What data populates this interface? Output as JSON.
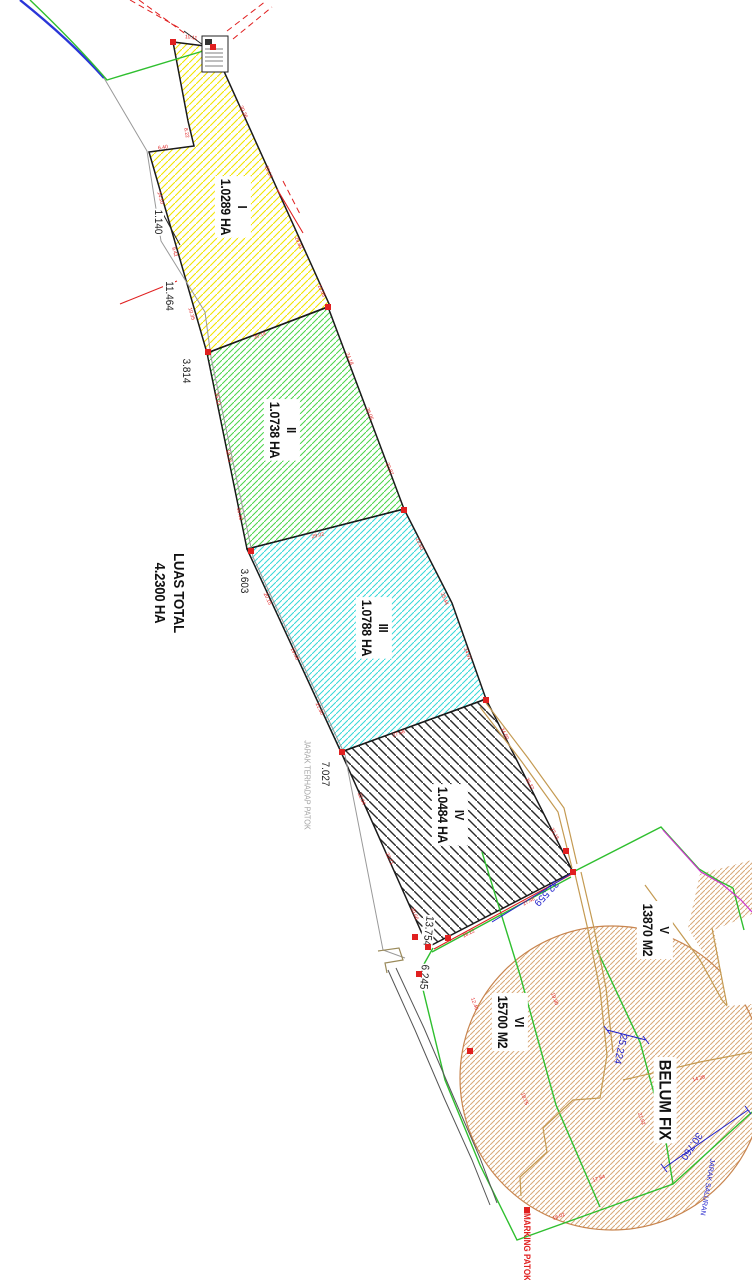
{
  "parcels": [
    {
      "numeral": "I",
      "area": "1.0289 HA"
    },
    {
      "numeral": "II",
      "area": "1.0738 HA"
    },
    {
      "numeral": "III",
      "area": "1.0788 HA"
    },
    {
      "numeral": "IV",
      "area": "1.0484 HA"
    },
    {
      "numeral": "V",
      "area": "13870 M2"
    },
    {
      "numeral": "VI",
      "area": "15700 M2"
    }
  ],
  "total": {
    "line1": "LUAS TOTAL",
    "line2": "4.2300 HA"
  },
  "annotations": {
    "belum_fix": "BELUM FIX",
    "jarak_terhadap_patok": "JARAK TERHADAP PATOK",
    "marking_patok": "MARKING PATOK",
    "jarak_saluran": "JARAK SALURAN"
  },
  "measurements": {
    "m1": "1.140",
    "m2": "11.464",
    "m3": "3.814",
    "m4": "3.603",
    "m5": "7.027",
    "m6": "13.754",
    "m7": "6.245"
  },
  "blue_dims": {
    "d1": "32.559",
    "d2": "25.224",
    "d3": "30.760"
  },
  "colors": {
    "hatch_yellow": "#f2e400",
    "hatch_green": "#4ad54a",
    "hatch_cyan": "#35d8d8",
    "hatch_black": "#2a2a2a",
    "hatch_brown": "#d8a878",
    "boundary_green": "#2fbf2f",
    "line_blue": "#2a35d8",
    "dim_blue": "#2222cc",
    "line_red": "#e02020",
    "line_magenta": "#cc33cc",
    "road_tan": "#c49a52"
  },
  "edge_dims": [
    {
      "v": "30.26",
      "x": 243,
      "y": 112,
      "a": 66
    },
    {
      "v": "28.14",
      "x": 268,
      "y": 172,
      "a": 66
    },
    {
      "v": "29.83",
      "x": 298,
      "y": 243,
      "a": 66
    },
    {
      "v": "10.05",
      "x": 321,
      "y": 291,
      "a": 66
    },
    {
      "v": "10.11",
      "x": 191,
      "y": 38,
      "a": 7
    },
    {
      "v": "14.10",
      "x": 160,
      "y": 198,
      "a": 74
    },
    {
      "v": "9.42",
      "x": 174,
      "y": 252,
      "a": 74
    },
    {
      "v": "10.35",
      "x": 191,
      "y": 314,
      "a": 74
    },
    {
      "v": "6.40",
      "x": 163,
      "y": 148,
      "a": -8
    },
    {
      "v": "8.22",
      "x": 186,
      "y": 133,
      "a": 80
    },
    {
      "v": "26.14",
      "x": 260,
      "y": 336,
      "a": -21
    },
    {
      "v": "15.22",
      "x": 217,
      "y": 399,
      "a": 79
    },
    {
      "v": "18.73",
      "x": 228,
      "y": 456,
      "a": 79
    },
    {
      "v": "16.40",
      "x": 239,
      "y": 514,
      "a": 79
    },
    {
      "v": "24.18",
      "x": 349,
      "y": 359,
      "a": 69
    },
    {
      "v": "26.05",
      "x": 369,
      "y": 414,
      "a": 69
    },
    {
      "v": "22.87",
      "x": 389,
      "y": 469,
      "a": 69
    },
    {
      "v": "29.02",
      "x": 318,
      "y": 536,
      "a": -14
    },
    {
      "v": "20.15",
      "x": 267,
      "y": 599,
      "a": 65
    },
    {
      "v": "19.48",
      "x": 294,
      "y": 654,
      "a": 65
    },
    {
      "v": "21.30",
      "x": 319,
      "y": 709,
      "a": 65
    },
    {
      "v": "23.60",
      "x": 419,
      "y": 544,
      "a": 67
    },
    {
      "v": "25.44",
      "x": 444,
      "y": 599,
      "a": 67
    },
    {
      "v": "24.91",
      "x": 467,
      "y": 654,
      "a": 67
    },
    {
      "v": "27.58",
      "x": 399,
      "y": 734,
      "a": -20
    },
    {
      "v": "22.04",
      "x": 361,
      "y": 799,
      "a": 66
    },
    {
      "v": "23.71",
      "x": 389,
      "y": 859,
      "a": 66
    },
    {
      "v": "20.66",
      "x": 414,
      "y": 914,
      "a": 66
    },
    {
      "v": "24.50",
      "x": 504,
      "y": 734,
      "a": 63
    },
    {
      "v": "26.37",
      "x": 529,
      "y": 784,
      "a": 63
    },
    {
      "v": "23.15",
      "x": 554,
      "y": 834,
      "a": 63
    },
    {
      "v": "28.22",
      "x": 469,
      "y": 934,
      "a": -27
    },
    {
      "v": "27.46",
      "x": 529,
      "y": 902,
      "a": -27
    },
    {
      "v": "19.30",
      "x": 554,
      "y": 999,
      "a": 70
    },
    {
      "v": "18.75",
      "x": 524,
      "y": 1099,
      "a": 70
    },
    {
      "v": "21.52",
      "x": 641,
      "y": 1119,
      "a": 70
    },
    {
      "v": "17.64",
      "x": 599,
      "y": 1179,
      "a": -20
    },
    {
      "v": "14.28",
      "x": 699,
      "y": 1079,
      "a": -15
    },
    {
      "v": "12.40",
      "x": 474,
      "y": 1004,
      "a": 70
    },
    {
      "v": "16.02",
      "x": 559,
      "y": 1217,
      "a": -20
    }
  ],
  "markers": [
    [
      173,
      42
    ],
    [
      213,
      47
    ],
    [
      328,
      307
    ],
    [
      208,
      352
    ],
    [
      404,
      510
    ],
    [
      251,
      551
    ],
    [
      486,
      700
    ],
    [
      342,
      752
    ],
    [
      566,
      851
    ],
    [
      573,
      872
    ],
    [
      428,
      947
    ],
    [
      419,
      974
    ],
    [
      415,
      937
    ],
    [
      448,
      938
    ],
    [
      470,
      1051
    ],
    [
      527,
      1210
    ]
  ]
}
